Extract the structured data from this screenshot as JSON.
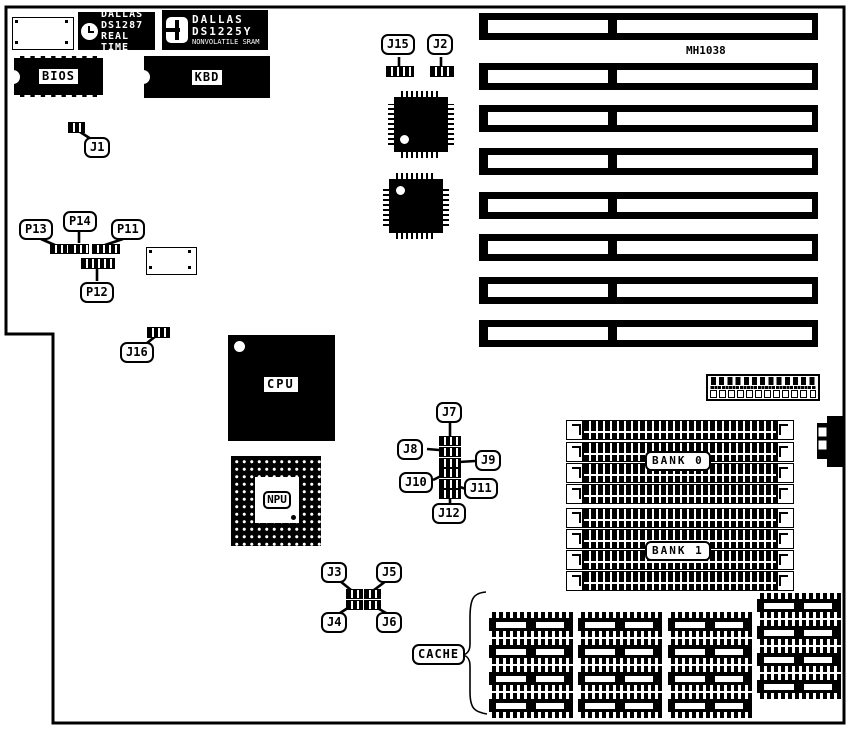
{
  "board": {
    "model_label": "MH1038"
  },
  "chips": {
    "rtc": {
      "brand": "DALLAS",
      "model": "DS1287",
      "subtitle": "REAL TIME"
    },
    "sram": {
      "brand": "DALLAS",
      "model": "DS1225Y",
      "subtitle": "NONVOLATILE SRAM"
    },
    "bios": "BIOS",
    "kbd": "KBD",
    "cpu": "CPU",
    "npu": "NPU"
  },
  "memory": {
    "bank0": "BANK 0",
    "bank1": "BANK 1",
    "cache": "CACHE"
  },
  "jumpers": {
    "j1": "J1",
    "j2": "J2",
    "j3": "J3",
    "j4": "J4",
    "j5": "J5",
    "j6": "J6",
    "j7": "J7",
    "j8": "J8",
    "j9": "J9",
    "j10": "J10",
    "j11": "J11",
    "j12": "J12",
    "j15": "J15",
    "j16": "J16",
    "p11": "P11",
    "p12": "P12",
    "p13": "P13",
    "p14": "P14"
  },
  "counts": {
    "isa_slots": 8,
    "simm_sockets_per_bank": 4,
    "cache_chips": 16
  }
}
